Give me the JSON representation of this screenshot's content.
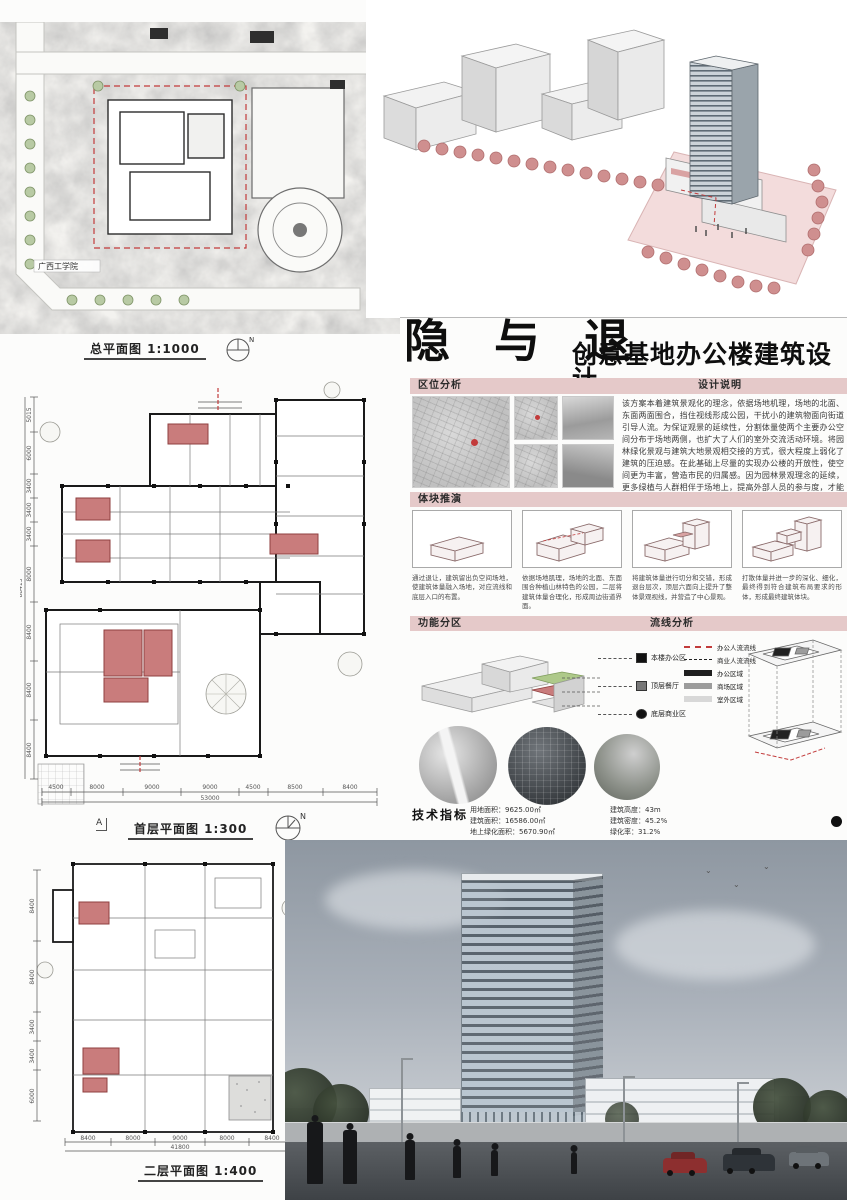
{
  "colors": {
    "banner_pink": "#e5c9c9",
    "core_pink": "#c97c7c",
    "core_pink_dark": "#8f3f3f",
    "tree_pink": "#cf8f8f",
    "flow_red": "#c23b3b",
    "zone_office": "#1f1f1f",
    "zone_mall": "#9c9c9c",
    "zone_outdoor": "#d8d8d8",
    "sky_top": "#8e97a1",
    "sky_bottom": "#c2c7cd",
    "road": "#4e5256"
  },
  "title": {
    "main": "隐 与 退",
    "subtitle": "创意基地办公楼建筑设计"
  },
  "north_label": "N",
  "site_plan": {
    "label": "总平面图 1:1000",
    "site_label": "广西工学院"
  },
  "location": {
    "header": "区位分析"
  },
  "description": {
    "header": "设计说明",
    "text": "该方案本着建筑景观化的理念，依据场地机理，场地的北面、东面两面围合，挡住视线形成公园，干扰小的建筑物面向街道引导人流。为保证观景的延续性，分割体量使两个主要办公空间分布于场地两侧，也扩大了人们的室外交流活动环境。将园林绿化景观与建筑大地景观相交接的方式，很大程度上弱化了建筑的压迫感。在此基础上尽量的实现办公楼的开放性，使空间更为丰富，营造市民的归属感。因为园林景观理念的延续，更多绿植与人群相伴于场地上，提高外部人员的参与度，才能使创意基地办公楼得到更好的利用。"
  },
  "massing": {
    "header": "体块推演",
    "captions": [
      "通过退让，建筑留出负空间场地，使建筑体量融入场地，对应流线和底层入口的布置。",
      "依据场地肌理，场地的北面、东面围合种植山林特色的公园，二层将建筑体量合理化，形成周边街道界面。",
      "将建筑体量进行切分和交错，形成退台层次，顶层六面向上提升了整体景观视线，并营造了中心景观。",
      "打散体量并进一步的深化、细化，最终得到符合建筑布局要求的形体，形成最终建筑体块。"
    ]
  },
  "zoning": {
    "header": "功能分区",
    "legend": [
      {
        "label": "本楼办公区"
      },
      {
        "label": "顶层餐厅"
      },
      {
        "label": "底层商业区"
      }
    ]
  },
  "circulation": {
    "header": "流线分析",
    "legend": [
      {
        "label": "办公人流流线"
      },
      {
        "label": "商业人流流线"
      },
      {
        "label": "办公区域"
      },
      {
        "label": "商场区域"
      },
      {
        "label": "室外区域"
      }
    ]
  },
  "indicators": {
    "header": "技术指标",
    "left": [
      "用地面积：9625.00㎡",
      "建筑面积：16586.00㎡",
      "地上绿化面积：5670.90㎡",
      "容积率：1.62"
    ],
    "right": [
      "建筑高度：43m",
      "建筑密度：45.2%",
      "绿化率：31.2%",
      "车位数：97　非机动车位：400"
    ]
  },
  "plans": {
    "first": {
      "label": "首层平面图 1:300",
      "marker": "A",
      "dims_bottom": [
        "4500",
        "8000",
        "9000",
        "9000",
        "4500",
        "8500",
        "8400"
      ],
      "total_bottom": "53000",
      "dims_left": [
        "5015",
        "6000",
        "3400",
        "3400",
        "3400",
        "8000",
        "8400",
        "8400",
        "8400"
      ],
      "total_left": "88415"
    },
    "second": {
      "label": "二层平面图 1:400",
      "dims_bottom": [
        "8400",
        "8000",
        "9000",
        "8000",
        "8400"
      ],
      "total_bottom": "41800",
      "dims_left": [
        "8400",
        "8400",
        "3400",
        "3400",
        "6000"
      ]
    }
  }
}
